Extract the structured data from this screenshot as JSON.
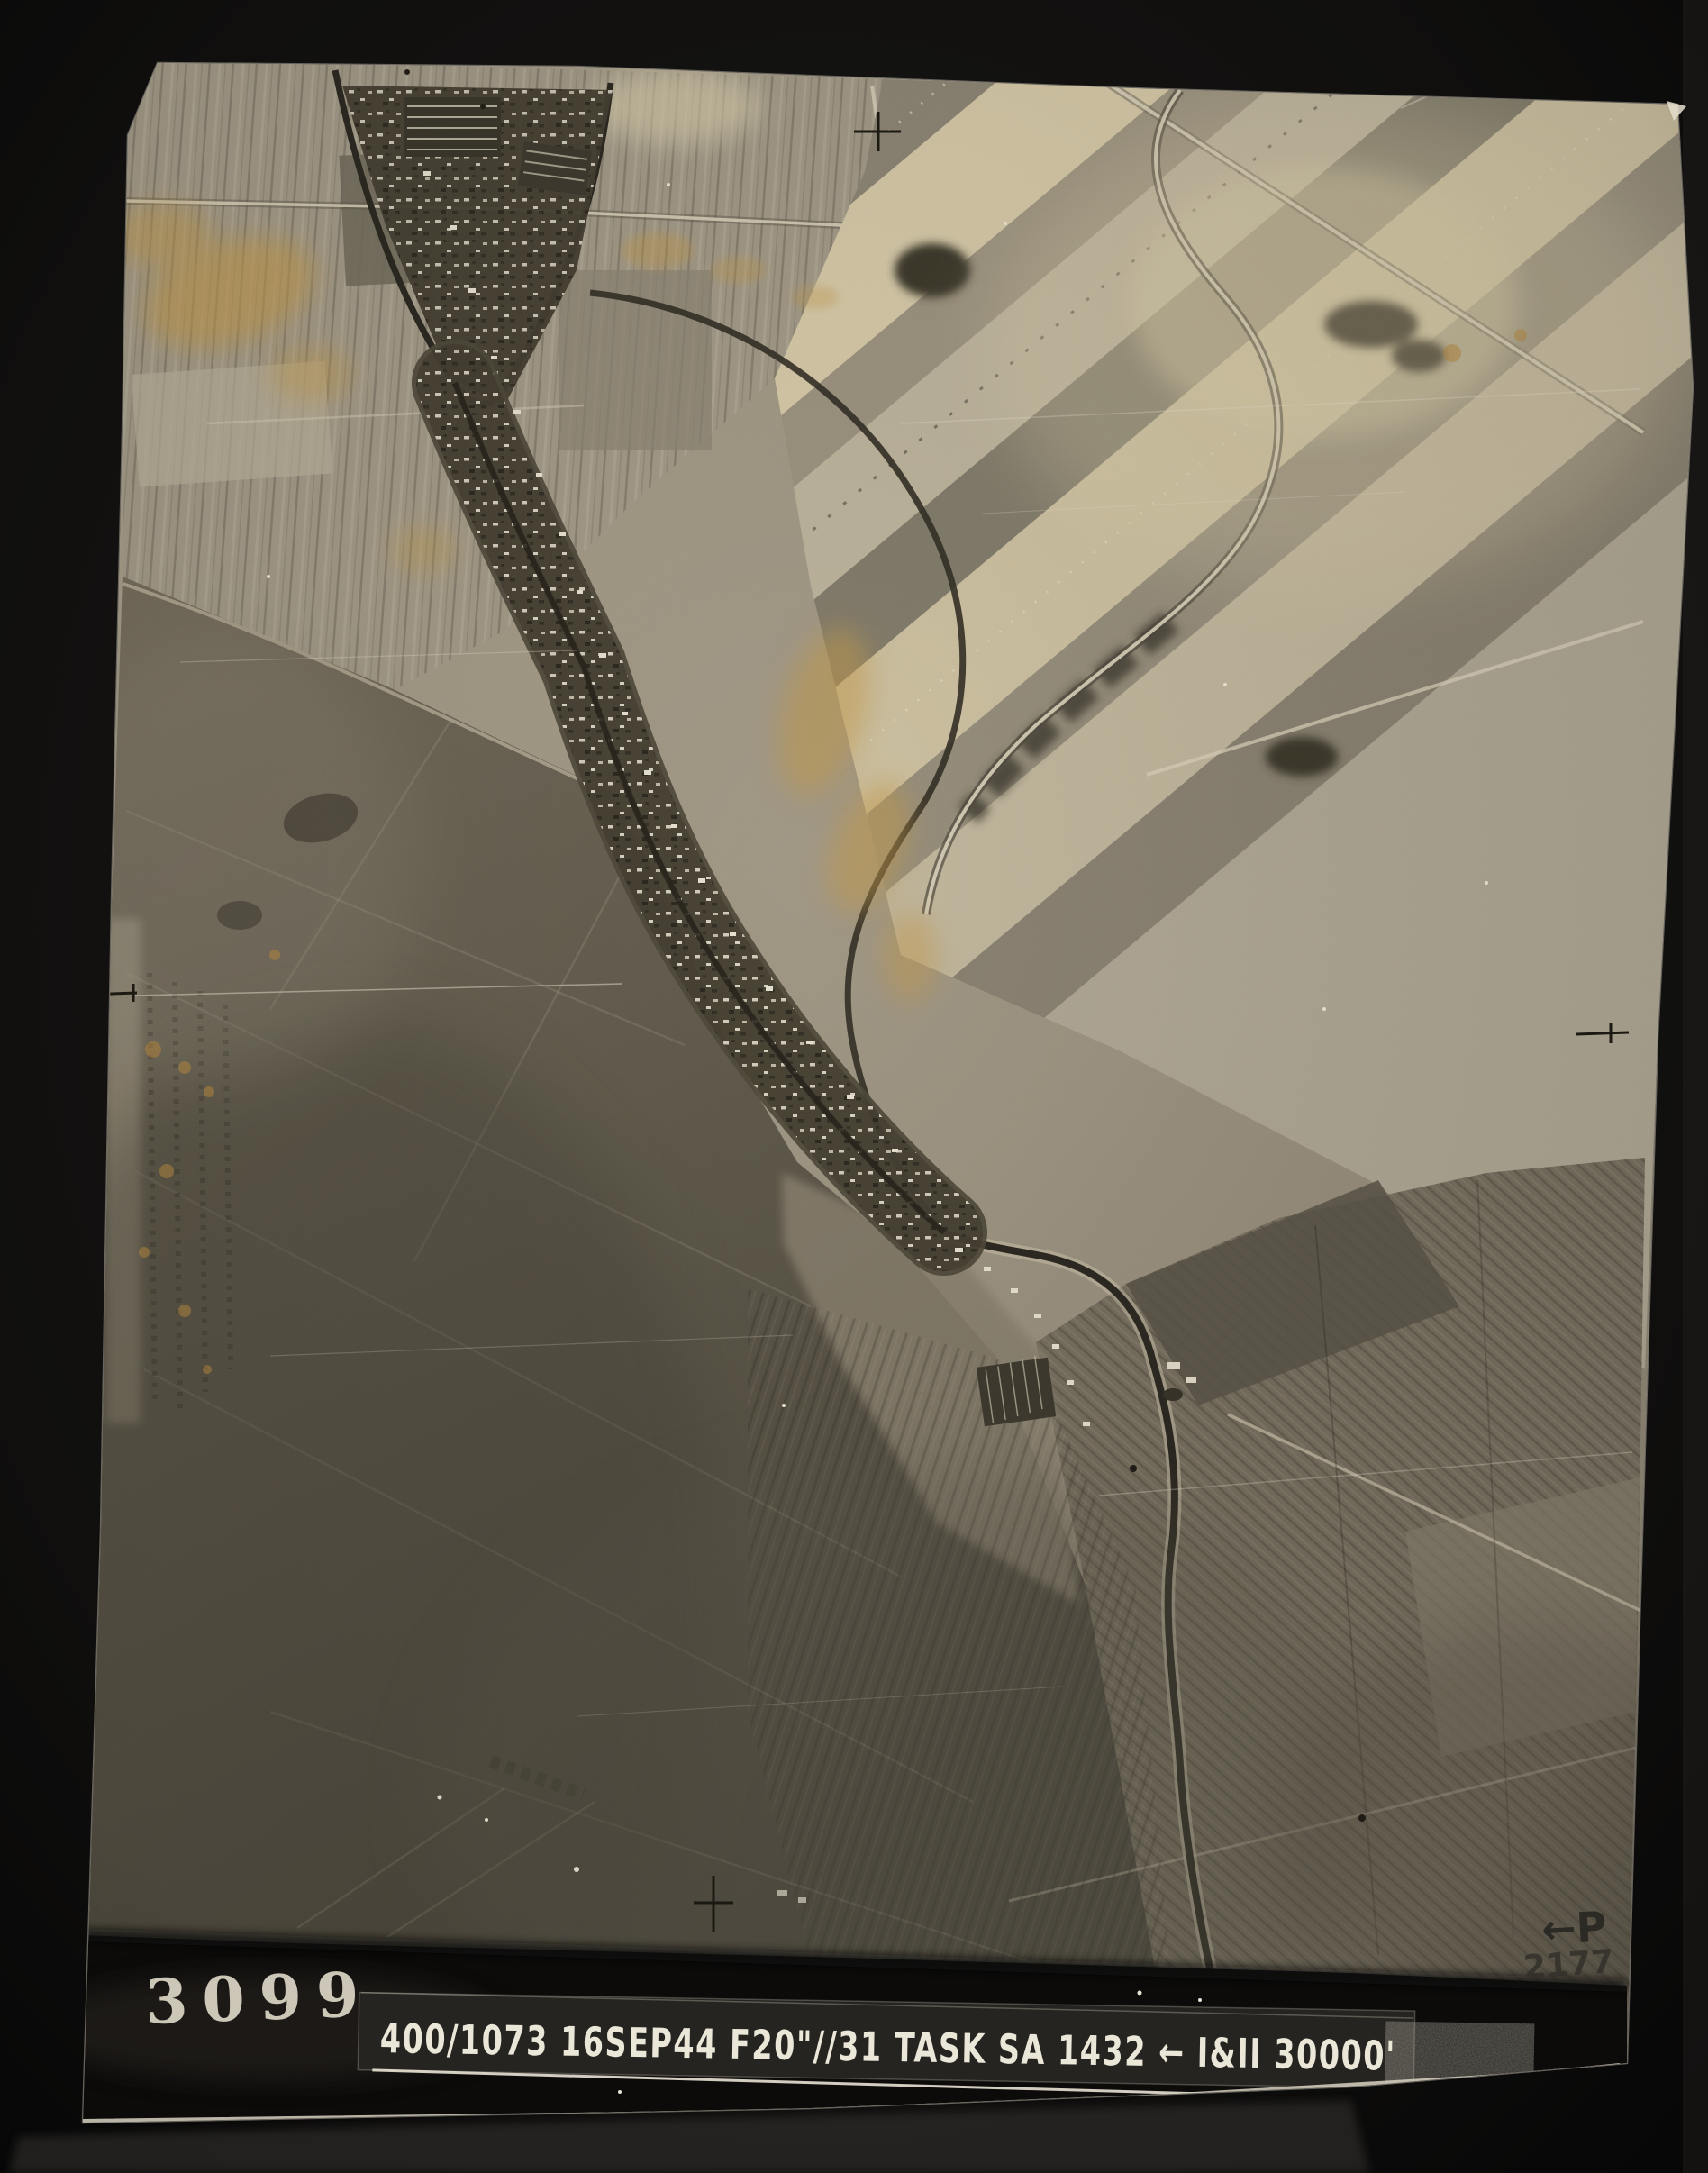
{
  "artifact": {
    "type": "vertical aerial reconnaissance photograph print on black album mount",
    "stamp_number": "3099",
    "title_strip_text": "400/1073 16SEP44 F20\"//31 TASK SA 1432 ← I&II 30000'",
    "title_strip_parts": [
      "400/1073",
      "16SEP44",
      "F20\"//31",
      "TASK",
      "SA 1432",
      "←",
      "I&II",
      "30000'"
    ],
    "pencil_note_arrow": "←P",
    "pencil_note_number": "2177"
  },
  "palette": {
    "mount_black": "#0d0d0c",
    "print_base": "#a79e8d",
    "highlight_cream": "#d6caa9",
    "shadow_dark": "#4b473e",
    "canal_dark": "#26241f",
    "stain_orange": "#c59949",
    "annotation_white": "#eae6d8"
  }
}
